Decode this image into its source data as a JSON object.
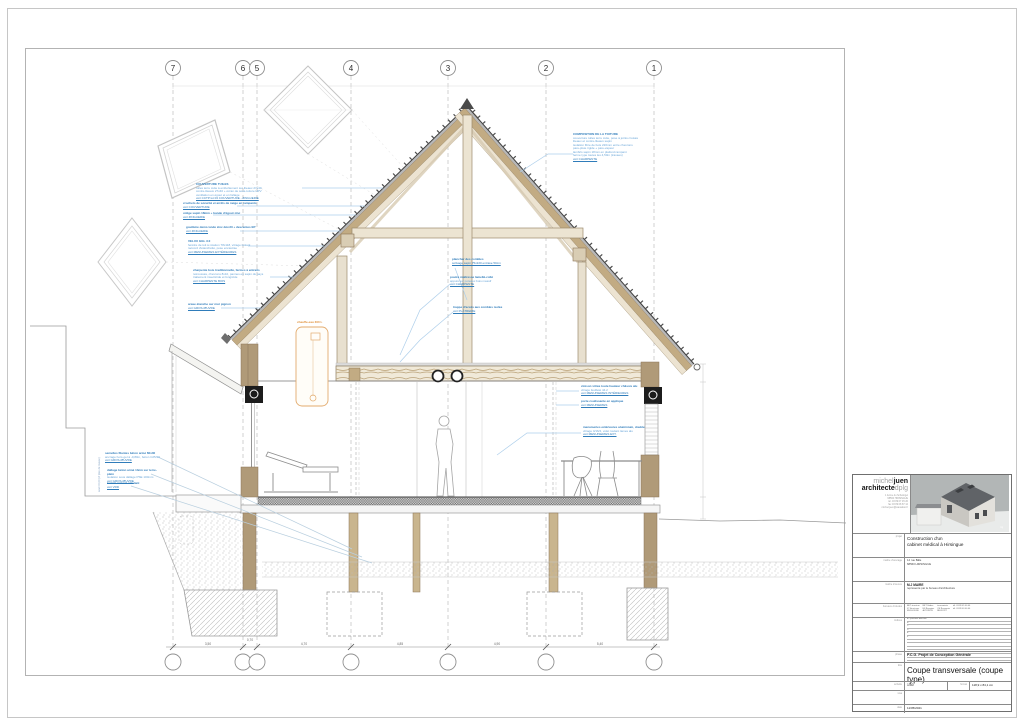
{
  "grid": {
    "labels": [
      "7",
      "6",
      "5",
      "4",
      "3",
      "2",
      "1"
    ]
  },
  "dims": {
    "bottom": [
      "3,50",
      "0,70",
      "4,70",
      "4,85",
      "4,90",
      "5,40"
    ]
  },
  "ann": {
    "left": [
      {
        "lines": [
          "COUVERTURE TUILES",
          "tuiles terre cuite à emboîtement sur liteaux 27x40",
          "contre-liteaux 27x40 + écran de sous-toiture HPV",
          "ventilation en égout et en faîtage",
          "voir CCTP lot 03 COUVERTURE - ZINGUERIE"
        ]
      },
      {
        "lines": [
          "crochets de sécurité et arrêts de neige en rampants",
          "voir COUVERTURE"
        ]
      },
      {
        "lines": [
          "volige sapin 18mm + bande d'égout zinc",
          "voir ZINGUERIE"
        ]
      },
      {
        "lines": [
          "gouttière demi-ronde zinc dév.33 + descentes EP",
          "voir ZINGUERIE"
        ]
      },
      {
        "lines": [
          "VELUX GGL 3.0",
          "fenêtre de toit à rotation 78x118, vitrage isolant",
          "raccord d'étanchéité, pose encastrée",
          "voir MENUISERIES EXTÉRIEURES"
        ]
      },
      {
        "lines": [
          "charpente bois traditionnelle, fermes à entraits",
          "retroussés, chevrons 8x10, pannes en sapin du pays",
          "traitement insecticide et fongicide",
          "voir CHARPENTE BOIS"
        ]
      },
      {
        "lines": [
          "arase étanche sur mur pignon",
          "voir GROS-ŒUVRE"
        ]
      }
    ],
    "roof_right": {
      "lines": [
        "COMPOSITION DE LA TOITURE",
        "couverture tuiles terre cuite, pose à joints croisés",
        "liteaux et contre-liteaux sapin",
        "isolation fibre de bois 220mm entre chevrons",
        "pare-pluie rigide + pare-vapeur",
        "lambris sapin 18mm en plafond rampant",
        "ferme type toutes les 4,50m (travées)",
        "voir CHARPENTE"
      ]
    },
    "attic": [
      {
        "lines": [
          "plancher des combles",
          "solivage sapin 75x220 entraxe 50cm"
        ]
      },
      {
        "lines": [
          "poutre maîtresse lamellé-collé",
          "appuis sur poteaux bois massif",
          "voir CHARPENTE"
        ]
      },
      {
        "lines": [
          "trappe d'accès aux combles isolée",
          "voir PLÂTRERIE"
        ]
      }
    ],
    "mid_right": [
      {
        "lines": [
          "cloison vitrée toute hauteur châssis alu",
          "vitrage feuilleté 44.2",
          "voir MENUISERIES INTÉRIEURES"
        ]
      },
      {
        "lines": [
          "porte coulissante en applique",
          "voir MENUISERIES"
        ]
      },
      {
        "lines": [
          "menuiseries extérieures aluminium, double",
          "vitrage 4/16/4, volet roulant lames alu",
          "voir MENUISERIES EXT."
        ]
      }
    ],
    "foundation": [
      {
        "lines": [
          "semelles filantes béton armé 60x30",
          "ancrage hors-gel à -0,80m, béton C25/30",
          "voir GROS-ŒUVRE"
        ]
      },
      {
        "lines": [
          "dallage béton armé 13cm sur terre-plein",
          "isolation sous dallage PSE 100mm",
          "voir GROS-ŒUVRE"
        ]
      },
      {
        "lines": [
          "terrain naturel existant",
          "voir VRD"
        ]
      }
    ],
    "vertical_note": "seuil ±0,00 (cf plan de masse)",
    "heater_label": "chauffe-eau 300 L"
  },
  "titleblock": {
    "logo": {
      "l1_thin": "michel",
      "l1_bold": "juen",
      "l2_bold": "architecte",
      "l2_thin": "dplg",
      "address": {
        "lines": [
          "1 ferme du Schwingel",
          "68560 HIRSINGUE",
          "tél. 03 89 07 45 20",
          "fax 03 89 08 87 12",
          "michel.juen@wanadoo.fr"
        ]
      }
    },
    "project": {
      "label": "projet",
      "lines": [
        "Construction d'un",
        "cabinet médical à Hirsingue"
      ]
    },
    "client": {
      "label": "maître d'ouvrage",
      "lines": [
        "14 rue Bâle",
        "68560 HIRSINGUE"
      ]
    },
    "moe": {
      "label": "maître d'œuvre",
      "name": "M.J MAIRE",
      "sub": "représenté par le bureau d'architecture"
    },
    "interv": {
      "label": "bureaux d'études",
      "col1": {
        "lines": [
          "BET structure",
          "IC Structures",
          "MULHOUSE"
        ]
      },
      "col2": {
        "lines": [
          "BET fluides",
          "ES Énergies",
          "ALTKIRCH"
        ]
      },
      "col3": {
        "lines": [
          "économiste",
          "CE Économie",
          "BELFORT"
        ]
      },
      "col4": {
        "lines": [
          "tél. 03 89 45 00 00",
          "tél. 03 89 40 00 00"
        ]
      }
    },
    "indices": {
      "label": "indices",
      "rows": [
        "A - première diffusion",
        "B",
        "C",
        "D",
        "E",
        "F",
        "",
        "",
        "",
        "",
        "",
        ""
      ]
    },
    "phase": {
      "label": "phase",
      "value": "P.C.G.   Projet de Conception Générale"
    },
    "title": {
      "label": "titre",
      "value": "Coupe transversale (coupe type)"
    },
    "scale": {
      "label": "échelle",
      "value": "1/50",
      "fmt_label": "format",
      "fmt_value": "118,9 x 84,1 cm"
    },
    "visa": {
      "label": "visa"
    },
    "date": {
      "label": "date",
      "value": "11/05/2021"
    }
  }
}
